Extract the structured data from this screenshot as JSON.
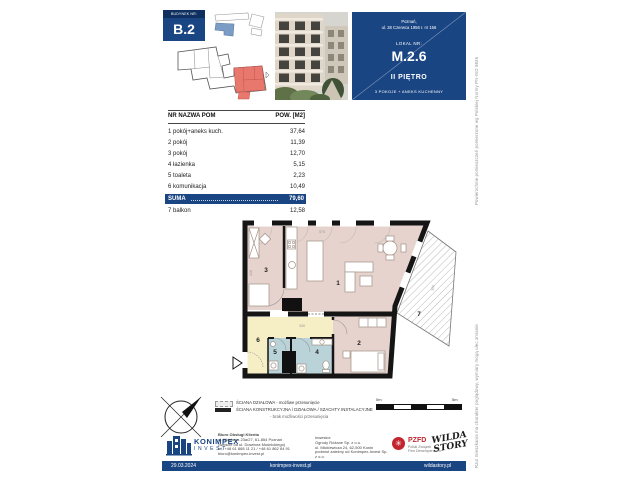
{
  "header": {
    "building_label": "BUDYNEK NR:",
    "building_no": "B.2",
    "city": "Poznań,",
    "address": "ul. 28 Czerwca 1956 r. nr 156",
    "unit_label": "LOKAL NR:",
    "unit_no": "M.2.6",
    "floor": "II PIĘTRO",
    "unit_type": "3 POKOJE + ANEKS KUCHENNY"
  },
  "table": {
    "col_name": "NR  NAZWA POM",
    "col_area": "POW. [M2]",
    "rows": [
      {
        "label": "1 pokój+aneks kuch.",
        "value": "37,64"
      },
      {
        "label": "2 pokój",
        "value": "11,39"
      },
      {
        "label": "3 pokój",
        "value": "12,70"
      },
      {
        "label": "4 łazienka",
        "value": "5,15"
      },
      {
        "label": "5 toaleta",
        "value": "2,23"
      },
      {
        "label": "6 komunikacja",
        "value": "10,49"
      }
    ],
    "suma_label": "SUMA",
    "suma_value": "79,60",
    "balkon_label": "7 balkon",
    "balkon_value": "12,58"
  },
  "plan": {
    "rooms": [
      "1",
      "2",
      "3",
      "4",
      "5",
      "6",
      "7"
    ],
    "dims": [
      "575",
      "345",
      "248",
      "355"
    ]
  },
  "legend": {
    "line1": "ŚCIANA DZIAŁOWA - możliwe przesunięcie",
    "line2": "ŚCIANA KONSTRUKCYJNA / DZIAŁOWA / SZACHTY  INSTALACYJNE",
    "line3": "- brak możliwości przesunięcia",
    "scale_start": "0m",
    "scale_end": "5m"
  },
  "footer": {
    "brand": "KONIMPEX",
    "brand_sub": "INVEST",
    "office": [
      "Biuro Obsługi Klienta",
      "ul. Mostowa 23a/27, 61-854 Poznań",
      "(wejście od ul. Dowbora Muśnickiego)",
      "tel. +48 61 868 11 21 / +48 61 862 64 91",
      "biuro@konimpex-invest.pl"
    ],
    "investor": [
      "Inwestor:",
      "Ogrody Różane Sp. z o.o.",
      "ul. Mickiewicza 24, 62-500 Konin",
      "podmiot zależny od Konimpex-Invest Sp. z o.o."
    ],
    "pzfd": "PZFD",
    "pzfd_icon": "✳",
    "pzfd_sub1": "Polski Związek",
    "pzfd_sub2": "Firm Deweloperskich",
    "wilda1": "WILDA",
    "wilda2": "STORY",
    "date": "29.03.2024",
    "url_left": "konimpex-invest.pl",
    "url_right": "wildastory.pl"
  },
  "disclaimer": {
    "seg1": "Powierzchnie pomieszczeń pomierzone wg Polskiej Normy PN-ISO 9836",
    "seg2": "Rzut mieszkania ma charakter poglądowy, wymiary mogą ulec zmianie"
  },
  "colors": {
    "navy": "#1a4583",
    "unit_highlight_red": "#e8786e",
    "room_pink": "#e7d3cd",
    "corridor_yellow": "#f6efc5",
    "bath_blue": "#b9d3d8",
    "pzfd_red": "#c2252e",
    "siteplan_blue": "#7b9cc4"
  }
}
